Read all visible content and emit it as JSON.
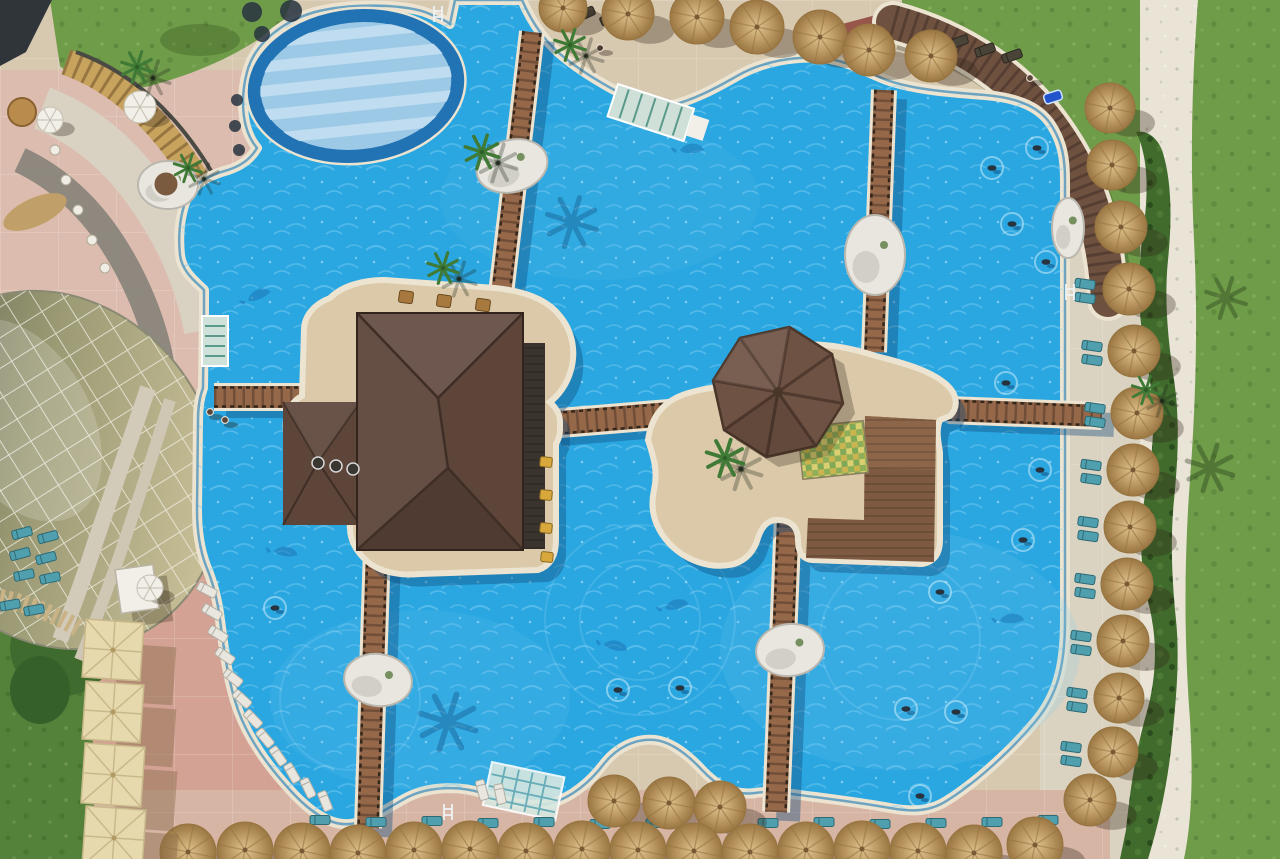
{
  "scene": {
    "type": "aerial-photo",
    "description": "Aerial drone view of a resort swimming pool complex with a pool bar, octagonal gazebo island, wooden bridges, thatch umbrellas, sun loungers and lawns",
    "time_of_day": "midday",
    "shadow_direction": "southeast"
  },
  "palette": {
    "pool": "#2aa7e1",
    "poolLight": "#74c8ee",
    "poolDeep": "#1872b2",
    "coping": "#ece4d0",
    "copingLine": "#1d7ab8",
    "deckTan": "#d7c8b0",
    "deckRight": "#dbd3c2",
    "deckPink": "#dcbcae",
    "deckSalmon": "#d3a294",
    "deckBottom": "#d6b5a5",
    "grass": "#6f9c49",
    "grassDark": "#55823a",
    "hedge": "#406b2c",
    "pathWhite": "#e9e4d6",
    "brick": "#96564a",
    "thatch": "#c4a169",
    "thatchDark": "#97743f",
    "cream": "#e6d9ae",
    "creamRib": "#c9b98a",
    "wood": "#96684a",
    "woodDark": "#33261b",
    "roof": "#5d453a",
    "roofDark": "#3f2e25",
    "roofLight": "#7a5c4c",
    "counter": "#3b342e",
    "octagon": "#6e5243",
    "islandDeck": "#dbc9a9",
    "woodDeck": "#7d5a41",
    "woodDeckLight": "#8d6649",
    "shallow": "#9ccae6",
    "shallowStripe": "#bfdcf0",
    "shallowRing": "#2273b4",
    "teal": "#4f9fae",
    "tealLight": "#9cc8c2",
    "white": "#f2efe8",
    "rock": "#e8e6df",
    "rockShade": "#b9b7ae",
    "navy": "#27333f",
    "yellow": "#d9a83c",
    "domeOlive": "#5e6450",
    "shadow": "rgba(50,38,24,0.32)",
    "waterShadow": "rgba(14,70,120,0.38)"
  },
  "objects": {
    "thatch_umbrellas": [
      [
        563,
        8,
        24
      ],
      [
        628,
        14,
        26
      ],
      [
        697,
        17,
        27
      ],
      [
        757,
        27,
        27
      ],
      [
        820,
        37,
        27
      ],
      [
        869,
        50,
        26
      ],
      [
        931,
        56,
        26
      ],
      [
        1110,
        108,
        25
      ],
      [
        1112,
        165,
        25
      ],
      [
        1121,
        227,
        26
      ],
      [
        1129,
        289,
        26
      ],
      [
        1134,
        351,
        26
      ],
      [
        1137,
        413,
        26
      ],
      [
        1133,
        470,
        26
      ],
      [
        1130,
        527,
        26
      ],
      [
        1127,
        584,
        26
      ],
      [
        1123,
        641,
        26
      ],
      [
        1119,
        698,
        25
      ],
      [
        1113,
        752,
        25
      ],
      [
        1090,
        800,
        26
      ],
      [
        614,
        801,
        26
      ],
      [
        669,
        803,
        26
      ],
      [
        720,
        807,
        26
      ],
      [
        188,
        852,
        28
      ],
      [
        245,
        850,
        28
      ],
      [
        302,
        851,
        28
      ],
      [
        358,
        853,
        28
      ],
      [
        414,
        850,
        28
      ],
      [
        470,
        849,
        28
      ],
      [
        526,
        851,
        28
      ],
      [
        582,
        849,
        28
      ],
      [
        638,
        850,
        28
      ],
      [
        694,
        851,
        28
      ],
      [
        750,
        852,
        28
      ],
      [
        806,
        850,
        28
      ],
      [
        862,
        849,
        28
      ],
      [
        918,
        851,
        28
      ],
      [
        974,
        853,
        28
      ],
      [
        1035,
        845,
        28
      ]
    ],
    "cream_umbrellas": [
      [
        113,
        650,
        58
      ],
      [
        113,
        712,
        58
      ],
      [
        113,
        775,
        60
      ],
      [
        114,
        838,
        60
      ]
    ],
    "white_umbrellas": [
      [
        140,
        107,
        16
      ],
      [
        50,
        120,
        13
      ],
      [
        150,
        588,
        13
      ]
    ],
    "palms_deck": [
      [
        137,
        67,
        1
      ],
      [
        570,
        45,
        1
      ],
      [
        482,
        152,
        1.1
      ],
      [
        443,
        268,
        1
      ],
      [
        725,
        458,
        1.2
      ],
      [
        188,
        168,
        0.9
      ],
      [
        1146,
        390,
        0.9
      ]
    ],
    "palm_shadows_pool": [
      [
        572,
        222,
        1.6
      ],
      [
        448,
        722,
        1.8
      ],
      [
        700,
        512,
        1.3
      ]
    ],
    "palm_shadows_grass": [
      [
        1210,
        468,
        1.5
      ],
      [
        1226,
        298,
        1.3
      ]
    ],
    "rocks": [
      [
        168,
        185,
        30,
        24,
        0
      ],
      [
        512,
        166,
        36,
        26,
        -15
      ],
      [
        875,
        255,
        30,
        40,
        0
      ],
      [
        378,
        680,
        34,
        26,
        8
      ],
      [
        790,
        650,
        34,
        26,
        -6
      ],
      [
        1068,
        228,
        16,
        30,
        0
      ]
    ],
    "planter": [
      166,
      184,
      13
    ],
    "swimmers": [
      [
        1037,
        148
      ],
      [
        992,
        168
      ],
      [
        1012,
        224
      ],
      [
        1046,
        262
      ],
      [
        1006,
        383
      ],
      [
        1040,
        470
      ],
      [
        1023,
        540
      ],
      [
        940,
        592
      ],
      [
        956,
        712
      ],
      [
        906,
        709
      ],
      [
        920,
        796
      ],
      [
        680,
        688
      ],
      [
        275,
        608
      ],
      [
        618,
        690
      ]
    ],
    "ripple_rings": [
      [
        640,
        620,
        60
      ],
      [
        640,
        620,
        95
      ],
      [
        350,
        700,
        70
      ],
      [
        900,
        640,
        80
      ]
    ],
    "dolphins": [
      [
        248,
        300,
        -20
      ],
      [
        274,
        551,
        10
      ],
      [
        680,
        150,
        0
      ],
      [
        604,
        644,
        15
      ],
      [
        665,
        608,
        -10
      ],
      [
        1000,
        620,
        0
      ]
    ],
    "loungers_white": [
      [
        207,
        590,
        28
      ],
      [
        212,
        612,
        30
      ],
      [
        218,
        634,
        32
      ],
      [
        225,
        656,
        35
      ],
      [
        233,
        678,
        38
      ],
      [
        242,
        699,
        42
      ],
      [
        253,
        719,
        46
      ],
      [
        265,
        738,
        50
      ],
      [
        278,
        756,
        55
      ],
      [
        292,
        773,
        60
      ],
      [
        308,
        788,
        64
      ],
      [
        325,
        801,
        68
      ],
      [
        482,
        790,
        75
      ],
      [
        500,
        794,
        78
      ]
    ],
    "loungers_teal": [
      [
        22,
        533,
        -15
      ],
      [
        48,
        537,
        -15
      ],
      [
        20,
        554,
        -15
      ],
      [
        46,
        558,
        -15
      ],
      [
        24,
        575,
        -12
      ],
      [
        50,
        578,
        -12
      ],
      [
        10,
        605,
        -10
      ],
      [
        34,
        610,
        -10
      ],
      [
        1085,
        284,
        8
      ],
      [
        1085,
        298,
        8
      ],
      [
        1092,
        346,
        8
      ],
      [
        1092,
        360,
        8
      ],
      [
        1095,
        408,
        8
      ],
      [
        1095,
        422,
        8
      ],
      [
        1091,
        465,
        8
      ],
      [
        1091,
        479,
        8
      ],
      [
        1088,
        522,
        8
      ],
      [
        1088,
        536,
        8
      ],
      [
        1085,
        579,
        8
      ],
      [
        1085,
        593,
        8
      ],
      [
        1081,
        636,
        8
      ],
      [
        1081,
        650,
        8
      ],
      [
        1077,
        693,
        8
      ],
      [
        1077,
        707,
        8
      ],
      [
        1071,
        747,
        8
      ],
      [
        1071,
        761,
        8
      ],
      [
        320,
        820,
        0
      ],
      [
        376,
        822,
        0
      ],
      [
        432,
        821,
        0
      ],
      [
        488,
        823,
        0
      ],
      [
        544,
        822,
        0
      ],
      [
        600,
        824,
        0
      ],
      [
        656,
        823,
        0
      ],
      [
        712,
        824,
        0
      ],
      [
        768,
        823,
        0
      ],
      [
        824,
        822,
        0
      ],
      [
        880,
        824,
        0
      ],
      [
        936,
        823,
        0
      ],
      [
        992,
        822,
        0
      ],
      [
        1048,
        820,
        0
      ]
    ],
    "loungers_dark": [
      [
        560,
        10,
        -25
      ],
      [
        585,
        14,
        -25
      ],
      [
        610,
        18,
        -25
      ],
      [
        958,
        42,
        -20
      ],
      [
        985,
        50,
        -20
      ],
      [
        1012,
        56,
        -20
      ]
    ],
    "people_deck": [
      [
        210,
        412
      ],
      [
        225,
        420
      ],
      [
        600,
        48
      ],
      [
        1030,
        78
      ]
    ],
    "bushes_dark": [
      [
        252,
        12,
        10
      ],
      [
        291,
        11,
        11
      ],
      [
        262,
        34,
        8
      ],
      [
        237,
        100,
        6
      ],
      [
        235,
        126,
        6
      ],
      [
        239,
        150,
        6
      ]
    ],
    "towel_colors": [
      "#d94040",
      "#e8c232",
      "#3a78c8"
    ],
    "towel_pos": [
      948,
      50
    ],
    "float_pos": [
      1053,
      97
    ],
    "bar_stools_yellow": [
      [
        546,
        462
      ],
      [
        546,
        495
      ],
      [
        546,
        528
      ],
      [
        547,
        557
      ]
    ],
    "bar_stools_dark": [
      [
        318,
        463
      ],
      [
        336,
        466
      ],
      [
        353,
        469
      ]
    ],
    "island_tables": [
      [
        406,
        297
      ],
      [
        444,
        301
      ],
      [
        483,
        305
      ]
    ],
    "terrace_tables": [
      [
        55,
        150
      ],
      [
        66,
        180
      ],
      [
        78,
        210
      ],
      [
        92,
        240
      ],
      [
        105,
        268
      ]
    ],
    "brown_table": [
      22,
      112,
      14
    ],
    "ladders": [
      [
        1070,
        292
      ],
      [
        438,
        14
      ],
      [
        448,
        812
      ]
    ],
    "bridges": [
      [
        532,
        32,
        500,
        302,
        20
      ],
      [
        884,
        90,
        874,
        352,
        20
      ],
      [
        214,
        397,
        300,
        397,
        22
      ],
      [
        548,
        424,
        694,
        412,
        24
      ],
      [
        948,
        410,
        1102,
        416,
        22
      ],
      [
        788,
        516,
        776,
        812,
        22
      ],
      [
        377,
        548,
        368,
        828,
        22
      ]
    ]
  }
}
